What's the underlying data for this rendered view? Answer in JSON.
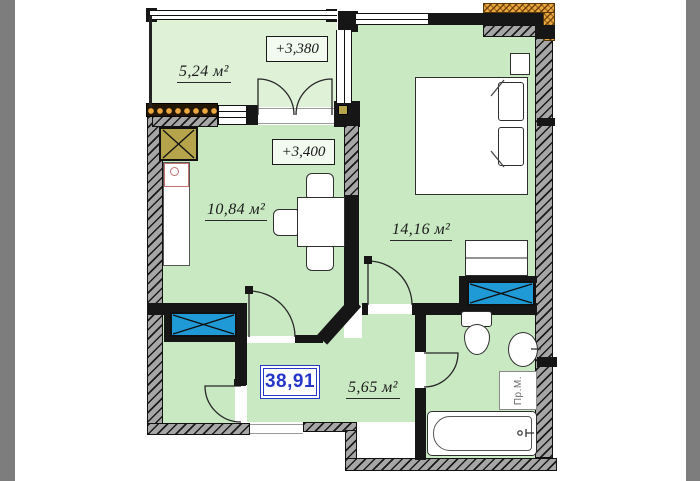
{
  "plan": {
    "total_area_m2": "38,91",
    "levels": {
      "balcony": "+3,380",
      "apartment": "+3,400"
    },
    "rooms": [
      {
        "name": "balcony",
        "area": "5,24 м²"
      },
      {
        "name": "kitchen-living",
        "area": "10,84 м²"
      },
      {
        "name": "bedroom",
        "area": "14,16 м²"
      },
      {
        "name": "hallway",
        "area": "5,65 м²"
      }
    ],
    "appliances": {
      "washing_machine": "Пр.М."
    }
  },
  "colors": {
    "wall": "#161616",
    "room_fill": "#c9e9c3",
    "balcony_fill": "#dff2d8",
    "vent_shaft_blue": "#1f9ad6",
    "chimney_khaki": "#b5a44c",
    "insulation_orange": "#eaa93f",
    "total_area_accent": "#2636c8"
  }
}
